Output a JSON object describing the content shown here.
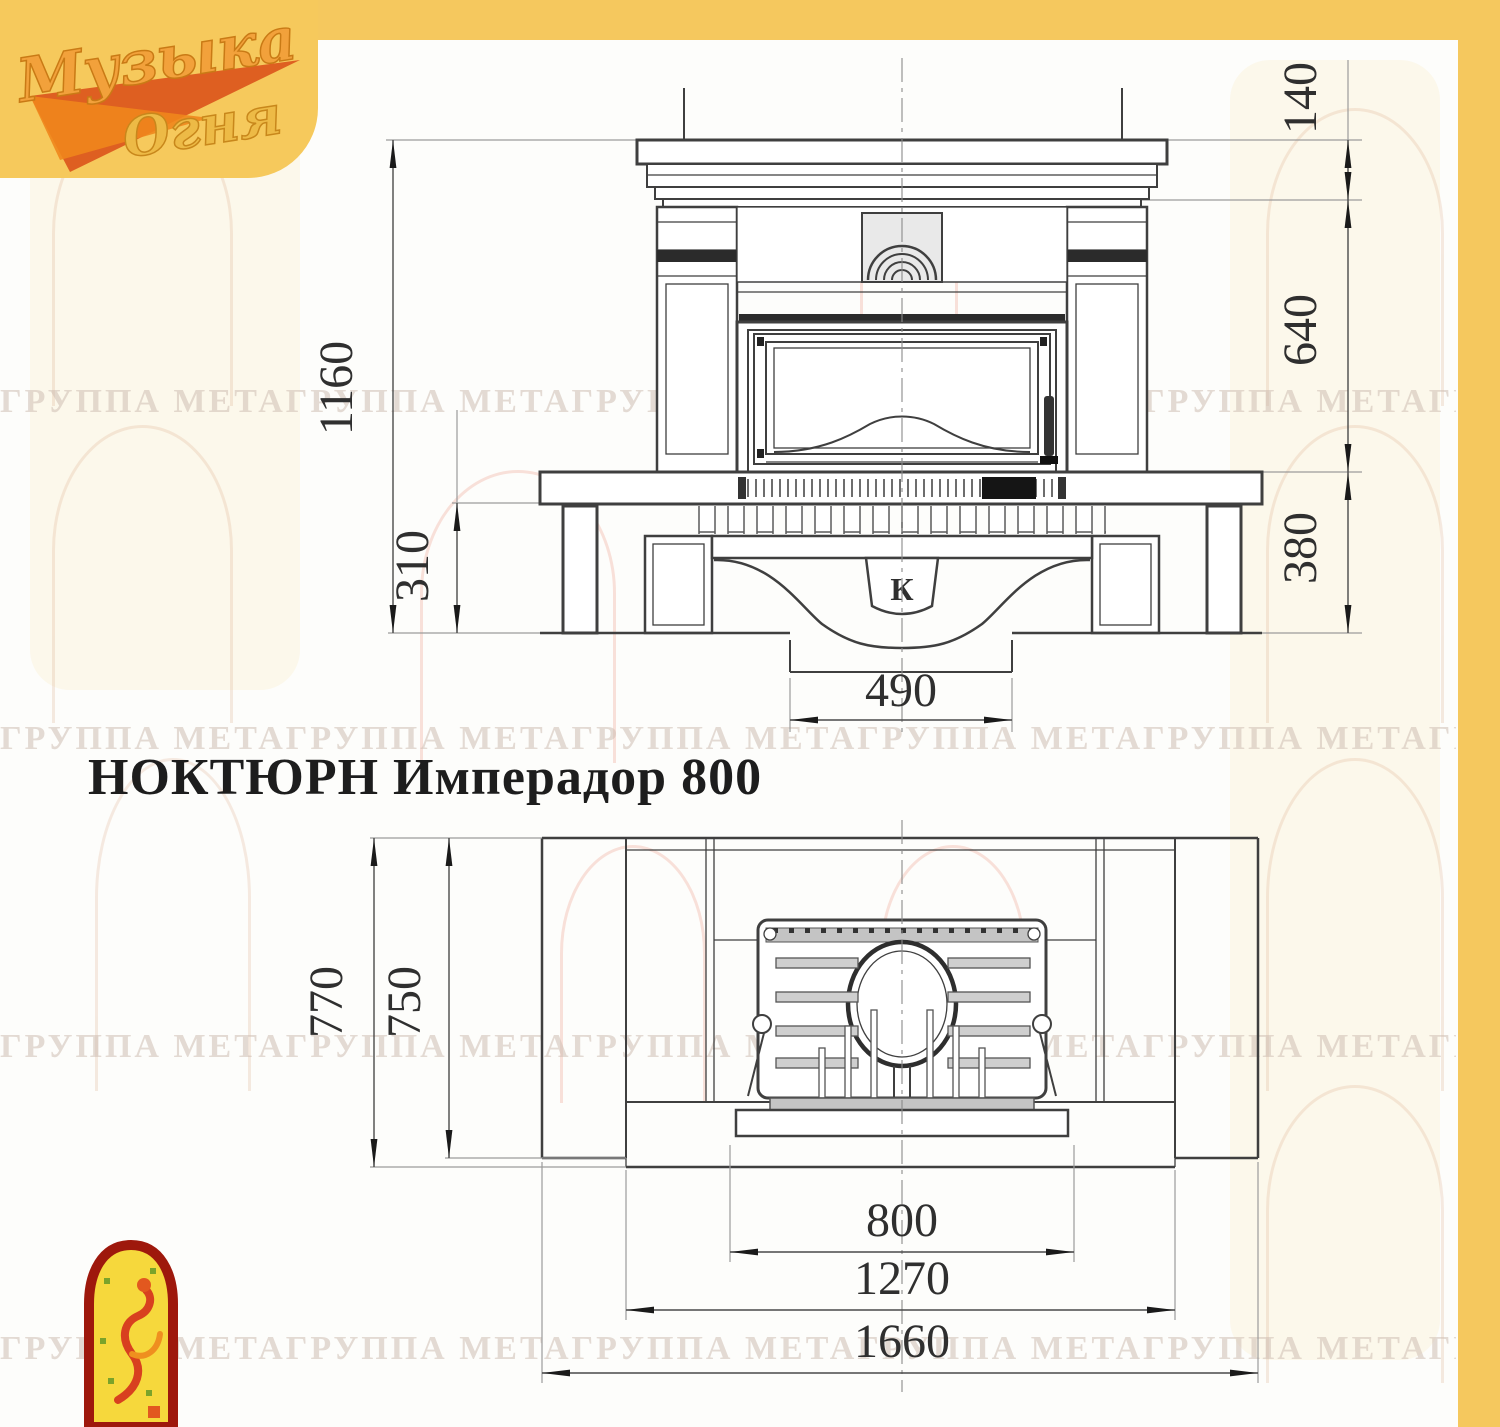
{
  "brand": {
    "logo_line1": "Музыка",
    "logo_line2": "Огня"
  },
  "title": "НОКТЮРН Имперадор 800",
  "watermark_text": "ГРУППА МЕТАГРУППА МЕТАГРУППА МЕТАГРУППА МЕТАГРУППА МЕТАГРУППА МЕТАГРУППА МЕТАГРУППА МЕТА",
  "front_view": {
    "description": "front elevation of fireplace",
    "keystone_letter": "К",
    "dimensions": {
      "total_height": "1160",
      "plinth_height": "310",
      "mantel_crown_height": "140",
      "opening_height": "640",
      "hearth_to_floor": "380",
      "base_duct_width": "490"
    }
  },
  "plan_view": {
    "description": "top plan view of fireplace",
    "dimensions": {
      "total_depth": "770",
      "body_depth": "750",
      "firebox_width": "800",
      "inner_width": "1270",
      "total_width": "1660"
    }
  },
  "colors": {
    "accent_yellow": "#f5c85e",
    "logo_orange": "#f2a13b",
    "logo_red": "#d94c16",
    "line_gray": "#3f3f3f",
    "dim_text": "#2f2f2f"
  }
}
